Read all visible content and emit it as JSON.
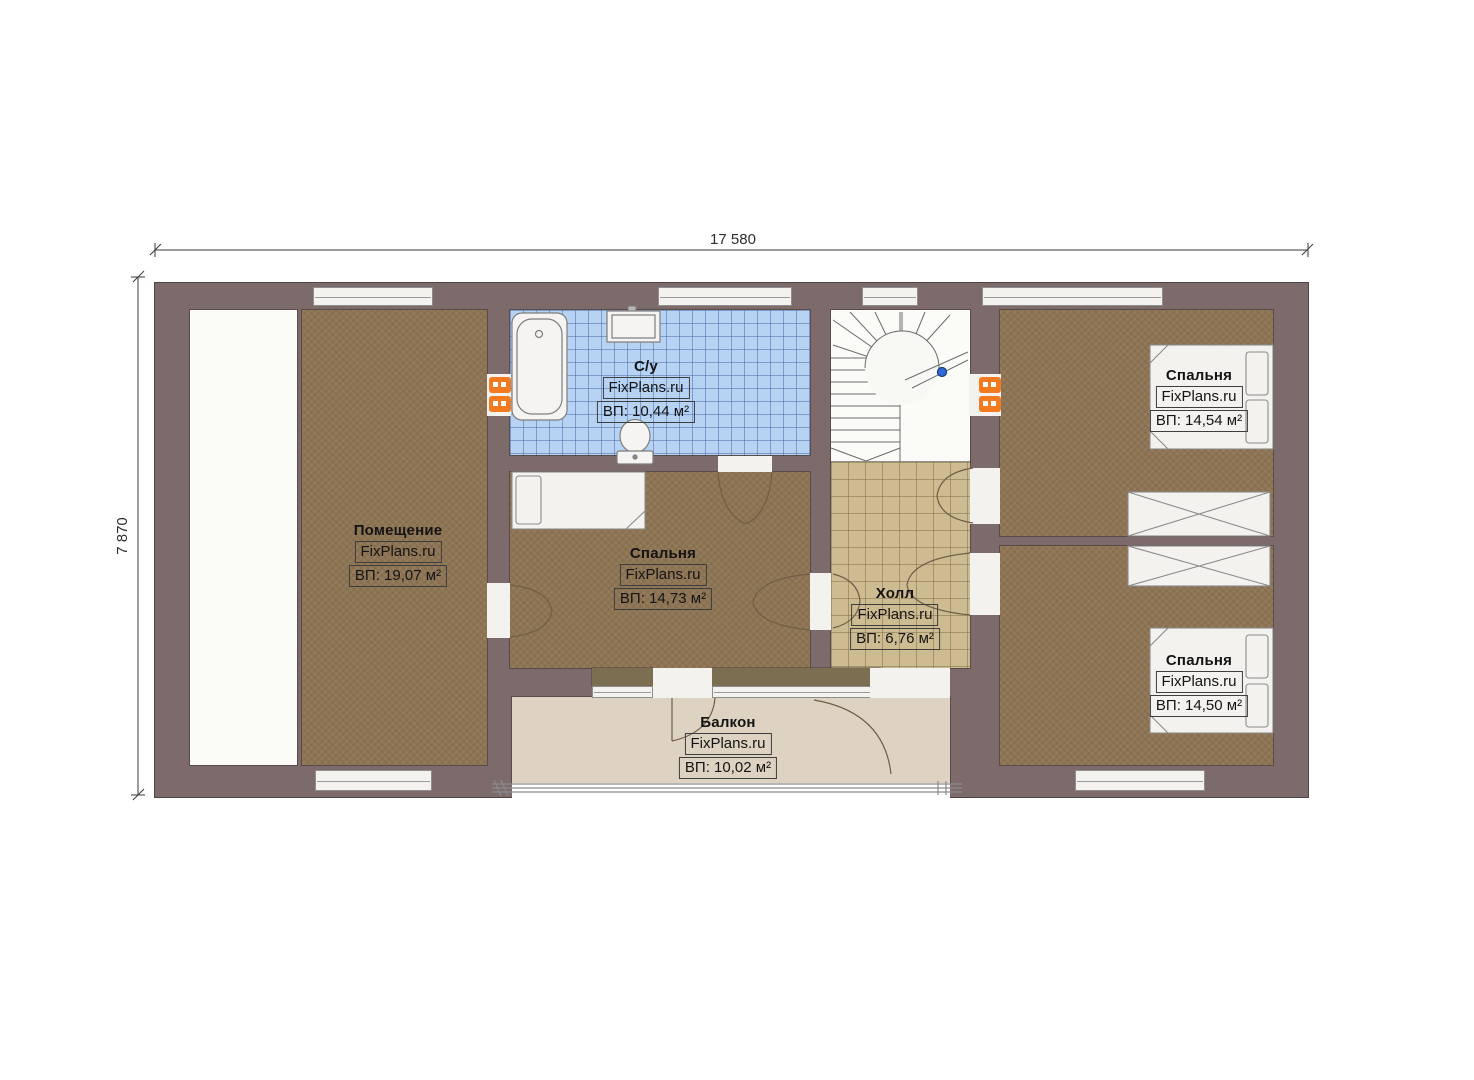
{
  "plan_title": "Floor plan (second floor)",
  "dimensions": {
    "width_label": "17 580",
    "height_label": "7 870"
  },
  "rooms": {
    "room": {
      "name": "Помещение",
      "brand": "FixPlans.ru",
      "area": "ВП: 19,07 м²"
    },
    "bathroom": {
      "name": "С/у",
      "brand": "FixPlans.ru",
      "area": "ВП: 10,44 м²"
    },
    "bedroom_middle": {
      "name": "Спальня",
      "brand": "FixPlans.ru",
      "area": "ВП: 14,73 м²"
    },
    "hall": {
      "name": "Холл",
      "brand": "FixPlans.ru",
      "area": "ВП: 6,76 м²"
    },
    "bedroom_top_right": {
      "name": "Спальня",
      "brand": "FixPlans.ru",
      "area": "ВП: 14,54 м²"
    },
    "bedroom_bottom_right": {
      "name": "Спальня",
      "brand": "FixPlans.ru",
      "area": "ВП: 14,50 м²"
    },
    "balcony": {
      "name": "Балкон",
      "brand": "FixPlans.ru",
      "area": "ВП: 10,02 м²"
    }
  },
  "colors": {
    "wall": "#7d6b6b",
    "floor_wood": "#8d7454",
    "bathroom_tile": "#b7d3f4",
    "hall_tile": "#cdbb92",
    "balcony_floor": "#ded3c2",
    "radiator_orange": "#f47a20",
    "marker_blue": "#2f6bd7"
  }
}
